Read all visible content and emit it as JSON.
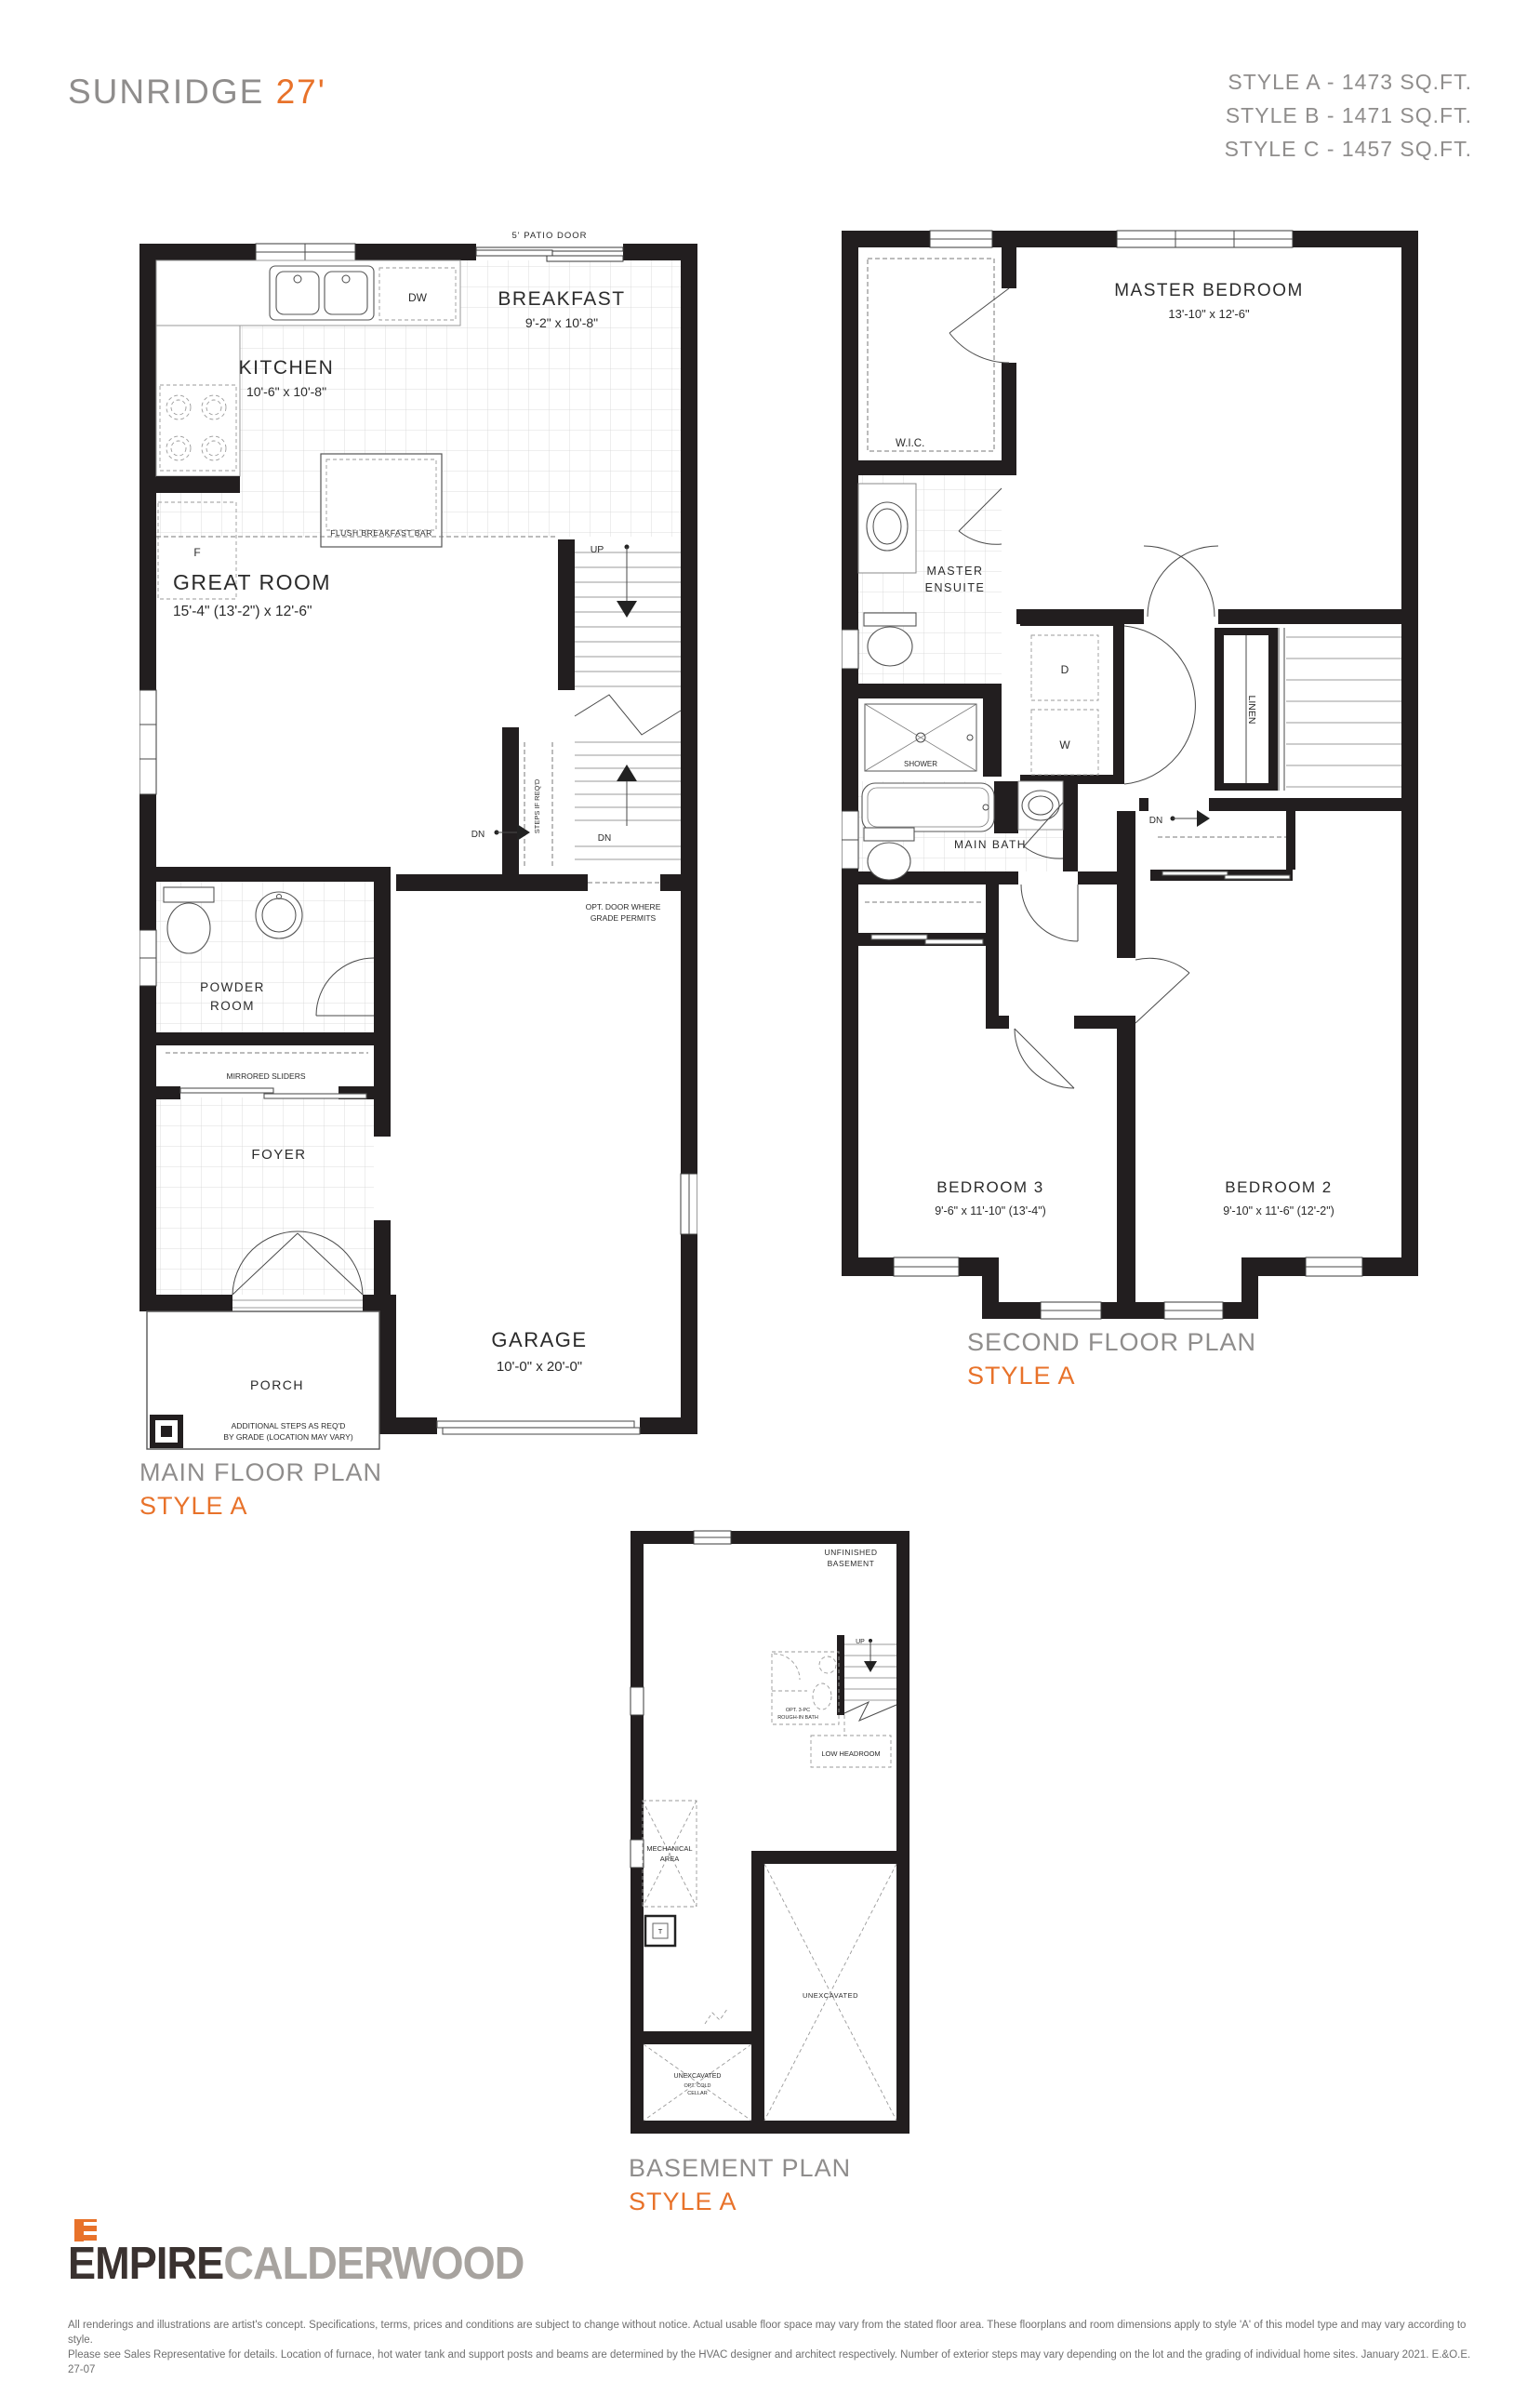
{
  "header": {
    "title": "SUNRIDGE",
    "lot": "27'",
    "styles": [
      "STYLE A - 1473 SQ.FT.",
      "STYLE B - 1471 SQ.FT.",
      "STYLE C - 1457 SQ.FT."
    ]
  },
  "colors": {
    "accent_orange": "#e8722a",
    "heading_gray": "#8f8d8c",
    "wall_black": "#221e1f",
    "logo_dark": "#3a3230",
    "logo_gray": "#a7a39f"
  },
  "main_floor": {
    "caption": "MAIN FLOOR PLAN",
    "style": "STYLE A",
    "labels": {
      "patio_door": "5' PATIO DOOR",
      "breakfast": "BREAKFAST",
      "breakfast_dims": "9'-2\" x 10'-8\"",
      "kitchen": "KITCHEN",
      "kitchen_dims": "10'-6\" x 10'-8\"",
      "dw": "DW",
      "fridge": "F",
      "island": "FLUSH BREAKFAST BAR",
      "great_room": "GREAT ROOM",
      "great_room_dims": "15'-4\" (13'-2\") x 12'-6\"",
      "up": "UP",
      "stair_dn": "DN",
      "basement_dn": "DN",
      "steps_if_reqd": "STEPS IF REQ'D",
      "opt_door_l1": "OPT. DOOR WHERE",
      "opt_door_l2": "GRADE PERMITS",
      "powder_l1": "POWDER",
      "powder_l2": "ROOM",
      "mirrored_sliders": "MIRRORED SLIDERS",
      "foyer": "FOYER",
      "porch": "PORCH",
      "steps_note_l1": "ADDITIONAL STEPS AS REQ'D",
      "steps_note_l2": "BY GRADE (LOCATION MAY VARY)",
      "garage": "GARAGE",
      "garage_dims": "10'-0\" x 20'-0\""
    }
  },
  "second_floor": {
    "caption": "SECOND FLOOR PLAN",
    "style": "STYLE A",
    "labels": {
      "master_bedroom": "MASTER BEDROOM",
      "master_dims": "13'-10\" x 12'-6\"",
      "wic": "W.I.C.",
      "ensuite_l1": "MASTER",
      "ensuite_l2": "ENSUITE",
      "shower": "SHOWER",
      "main_bath": "MAIN BATH",
      "dryer": "D",
      "washer": "W",
      "linen": "LINEN",
      "dn": "DN",
      "bedroom3": "BEDROOM 3",
      "bedroom3_dims": "9'-6\" x 11'-10\" (13'-4\")",
      "bedroom2": "BEDROOM 2",
      "bedroom2_dims": "9'-10\" x 11'-6\" (12'-2\")"
    }
  },
  "basement": {
    "caption": "BASEMENT PLAN",
    "style": "STYLE A",
    "labels": {
      "unfinished_l1": "UNFINISHED",
      "unfinished_l2": "BASEMENT",
      "up": "UP",
      "rough_in_l1": "OPT. 3-PC",
      "rough_in_l2": "ROUGH-IN BATH",
      "low_headroom": "LOW HEADROOM",
      "mechanical_l1": "MECHANICAL",
      "mechanical_l2": "AREA",
      "tank": "T",
      "unexcavated_main": "UNEXCAVATED",
      "unexcavated_small": "UNEXCAVATED",
      "cold_cellar_l1": "OPT. COLD",
      "cold_cellar_l2": "CELLAR"
    }
  },
  "footer": {
    "brand_primary": "EMPIRE",
    "brand_secondary": "CALDERWOOD",
    "disclaimer_l1": "All renderings and illustrations are artist's concept. Specifications, terms, prices and conditions are subject to change without notice. Actual usable floor space may vary from the stated floor area. These floorplans and room dimensions apply to style 'A' of this model type and may vary according to style.",
    "disclaimer_l2": "Please see Sales Representative for details. Location of furnace, hot water tank and support posts and beams are determined by the HVAC designer and architect respectively. Number of exterior steps may vary depending on the lot and the grading of individual home sites. January 2021. E.&O.E. 27-07"
  }
}
